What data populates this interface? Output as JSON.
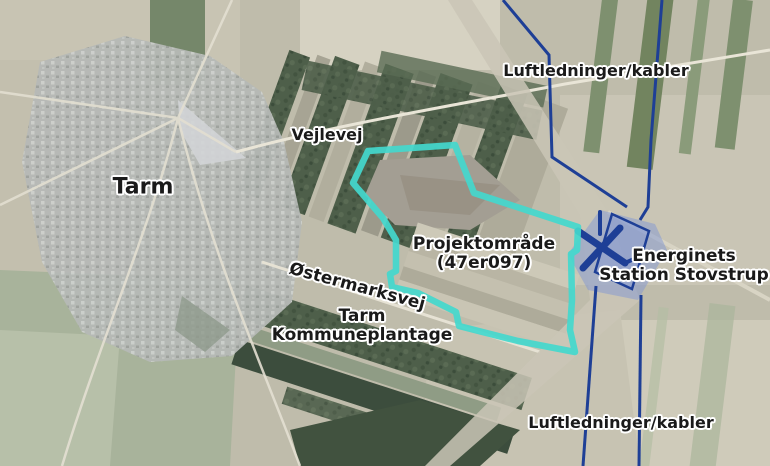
{
  "map": {
    "description": "Aerial map of Tarm area with project boundary and power line annotations",
    "labels": {
      "town": "Tarm",
      "road_vejlevej": "Vejlevej",
      "project_area_line1": "Projektområde",
      "project_area_line2": "(47er097)",
      "road_ostermarksvej": "Østermarksvej",
      "plantation_line1": "Tarm",
      "plantation_line2": "Kommuneplantage",
      "station_line1": "Energinets",
      "station_line2": "Station Stovstrup",
      "powerlines_top": "Luftledninger/kabler",
      "powerlines_bottom": "Luftledninger/kabler"
    },
    "colors": {
      "project_outline": "#43d8cd",
      "powerline": "#1e3f96",
      "station_fill": "#7b93d8",
      "label_text": "#1a1a1a",
      "label_halo": "#ffffff"
    }
  }
}
